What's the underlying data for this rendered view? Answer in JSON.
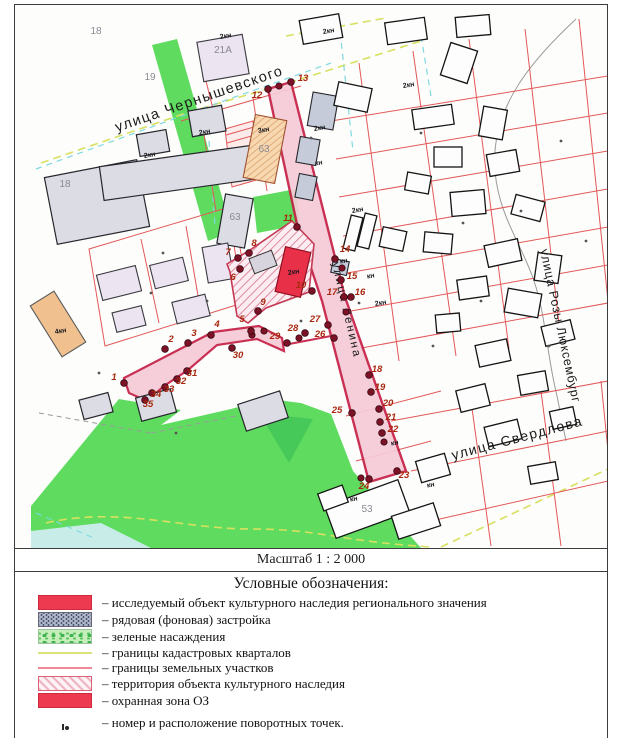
{
  "scale": {
    "label": "Масштаб 1 : 2 000"
  },
  "legend": {
    "title": "Условные обозначения:",
    "items": [
      {
        "key": "heritage-object",
        "label": "– исследуемый объект культурного наследия регионального значения"
      },
      {
        "key": "background-build",
        "label": "– рядовая (фоновая) застройка"
      },
      {
        "key": "greenery",
        "label": "– зеленые насаждения"
      },
      {
        "key": "cadastral-borders",
        "label": "– границы кадастровых кварталов"
      },
      {
        "key": "parcel-borders",
        "label": "– границы земельных участков"
      },
      {
        "key": "heritage-territory",
        "label": "– территория объекта культурного наследия"
      },
      {
        "key": "protection-zone",
        "label": "– охранная зона ОЗ"
      },
      {
        "key": "turning-points",
        "label": "– номер и расположение поворотных точек."
      }
    ]
  },
  "colors": {
    "accent_red": "#ee3a50",
    "zone_pink": "#f5cbd7",
    "zone_border": "#c51f45",
    "green": "#5fdc5f",
    "parcel_red": "#e25858",
    "cadastral_yellow": "#d9e060",
    "water": "#c8ede9",
    "point": "#7c1226",
    "point_label": "#a8280f"
  },
  "map": {
    "streets": [
      {
        "name": "chernyshevskogo",
        "label": "улица Чернышевского",
        "x": 116,
        "y": 131,
        "r": -19,
        "size": 14.5,
        "sp": 1.4,
        "color": "#1b1b1b"
      },
      {
        "name": "rozy-luxemburg",
        "label": "улица Розы Люксембург",
        "x": 539,
        "y": 249,
        "r": 78,
        "size": 12.5,
        "sp": 0.8,
        "color": "#1b1b1b"
      },
      {
        "name": "sverdlova",
        "label": "улица Свердлова",
        "x": 452,
        "y": 459,
        "r": -15,
        "size": 14,
        "sp": 1.4,
        "color": "#1b1b1b"
      },
      {
        "name": "lenina",
        "label": "улица Ленина",
        "x": 331,
        "y": 262,
        "r": 77,
        "size": 11.5,
        "sp": 2,
        "color": "#565b70"
      }
    ],
    "addr_labels": [
      {
        "t": "18",
        "x": 95,
        "y": 33
      },
      {
        "t": "19",
        "x": 149,
        "y": 79
      },
      {
        "t": "21А",
        "x": 222,
        "y": 52
      },
      {
        "t": "18",
        "x": 64,
        "y": 186
      },
      {
        "t": "63",
        "x": 234,
        "y": 219
      },
      {
        "t": "63",
        "x": 263,
        "y": 151
      },
      {
        "t": "53",
        "x": 366,
        "y": 511
      }
    ],
    "bld_labels": [
      {
        "t": "2кн",
        "x": 225,
        "y": 37
      },
      {
        "t": "2кн",
        "x": 204,
        "y": 133
      },
      {
        "t": "2кн",
        "x": 149,
        "y": 156
      },
      {
        "t": "2кн",
        "x": 328,
        "y": 32
      },
      {
        "t": "2кн",
        "x": 408,
        "y": 86
      },
      {
        "t": "2кн",
        "x": 319,
        "y": 129
      },
      {
        "t": "2кн",
        "x": 357,
        "y": 211
      },
      {
        "t": "2кн",
        "x": 380,
        "y": 304
      },
      {
        "t": "2кн",
        "x": 293,
        "y": 273
      }
    ],
    "small_labels": [
      {
        "t": "4кн",
        "x": 60,
        "y": 332
      },
      {
        "t": "3кн",
        "x": 263,
        "y": 131
      },
      {
        "t": "кн",
        "x": 318,
        "y": 164
      },
      {
        "t": "кн",
        "x": 343,
        "y": 262
      },
      {
        "t": "кн",
        "x": 370,
        "y": 277
      },
      {
        "t": "кн",
        "x": 394,
        "y": 444
      },
      {
        "t": "кн",
        "x": 430,
        "y": 486
      },
      {
        "t": "кн",
        "x": 353,
        "y": 500
      }
    ],
    "points": [
      {
        "n": 1,
        "x": 123,
        "y": 382,
        "lx": 113,
        "ly": 379
      },
      {
        "n": 2,
        "x": 164,
        "y": 348,
        "lx": 170,
        "ly": 341
      },
      {
        "n": 3,
        "x": 187,
        "y": 342,
        "lx": 193,
        "ly": 335
      },
      {
        "n": 4,
        "x": 210,
        "y": 334,
        "lx": 216,
        "ly": 326
      },
      {
        "n": 5,
        "x": 250,
        "y": 330,
        "lx": 241,
        "ly": 321
      },
      {
        "n": 6,
        "x": 239,
        "y": 268,
        "lx": 232,
        "ly": 279
      },
      {
        "n": 7,
        "x": 237,
        "y": 257,
        "lx": 227,
        "ly": 254
      },
      {
        "n": 8,
        "x": 248,
        "y": 252,
        "lx": 253,
        "ly": 245
      },
      {
        "n": 9,
        "x": 257,
        "y": 310,
        "lx": 262,
        "ly": 304
      },
      {
        "n": 10,
        "x": 311,
        "y": 290,
        "lx": 300,
        "ly": 287
      },
      {
        "n": 11,
        "x": 296,
        "y": 226,
        "lx": 287,
        "ly": 220
      },
      {
        "n": 12,
        "x": 267,
        "y": 88,
        "lx": 256,
        "ly": 97
      },
      {
        "n": 13,
        "x": 290,
        "y": 81,
        "lx": 302,
        "ly": 80
      },
      {
        "n": 14,
        "x": 334,
        "y": 258,
        "lx": 344,
        "ly": 251
      },
      {
        "n": 15,
        "x": 340,
        "y": 279,
        "lx": 351,
        "ly": 278
      },
      {
        "n": 16,
        "x": 350,
        "y": 296,
        "lx": 359,
        "ly": 294
      },
      {
        "n": 17,
        "x": 343,
        "y": 296,
        "lx": 331,
        "ly": 294
      },
      {
        "n": 18,
        "x": 368,
        "y": 374,
        "lx": 376,
        "ly": 371
      },
      {
        "n": 19,
        "x": 370,
        "y": 391,
        "lx": 379,
        "ly": 389
      },
      {
        "n": 20,
        "x": 378,
        "y": 408,
        "lx": 387,
        "ly": 405
      },
      {
        "n": 21,
        "x": 379,
        "y": 421,
        "lx": 390,
        "ly": 419
      },
      {
        "n": 22,
        "x": 381,
        "y": 432,
        "lx": 392,
        "ly": 431
      },
      {
        "n": 23,
        "x": 396,
        "y": 470,
        "lx": 403,
        "ly": 477
      },
      {
        "n": 24,
        "x": 368,
        "y": 478,
        "lx": 363,
        "ly": 488
      },
      {
        "n": 25,
        "x": 351,
        "y": 412,
        "lx": 336,
        "ly": 412
      },
      {
        "n": 26,
        "x": 333,
        "y": 337,
        "lx": 319,
        "ly": 336
      },
      {
        "n": 27,
        "x": 327,
        "y": 324,
        "lx": 314,
        "ly": 321
      },
      {
        "n": 28,
        "x": 304,
        "y": 332,
        "lx": 292,
        "ly": 330
      },
      {
        "n": 29,
        "x": 286,
        "y": 342,
        "lx": 274,
        "ly": 338
      },
      {
        "n": 30,
        "x": 231,
        "y": 347,
        "lx": 237,
        "ly": 357
      },
      {
        "n": 31,
        "x": 186,
        "y": 370,
        "lx": 191,
        "ly": 375
      },
      {
        "n": 32,
        "x": 176,
        "y": 378,
        "lx": 180,
        "ly": 383
      },
      {
        "n": 33,
        "x": 164,
        "y": 386,
        "lx": 168,
        "ly": 391
      },
      {
        "n": 34,
        "x": 151,
        "y": 392,
        "lx": 155,
        "ly": 396
      },
      {
        "n": 35,
        "x": 144,
        "y": 399,
        "lx": 147,
        "ly": 406
      }
    ],
    "extra_dots": [
      [
        278,
        85
      ],
      [
        251,
        334
      ],
      [
        263,
        330
      ],
      [
        298,
        337
      ],
      [
        383,
        441
      ],
      [
        360,
        477
      ],
      [
        345,
        311
      ],
      [
        341,
        267
      ]
    ],
    "trees": [
      [
        162,
        252
      ],
      [
        150,
        292
      ],
      [
        206,
        300
      ],
      [
        310,
        137
      ],
      [
        420,
        132
      ],
      [
        462,
        222
      ],
      [
        358,
        302
      ],
      [
        520,
        210
      ],
      [
        548,
        345
      ],
      [
        432,
        345
      ],
      [
        98,
        372
      ],
      [
        560,
        140
      ],
      [
        480,
        300
      ],
      [
        175,
        432
      ],
      [
        585,
        240
      ],
      [
        300,
        320
      ]
    ]
  }
}
